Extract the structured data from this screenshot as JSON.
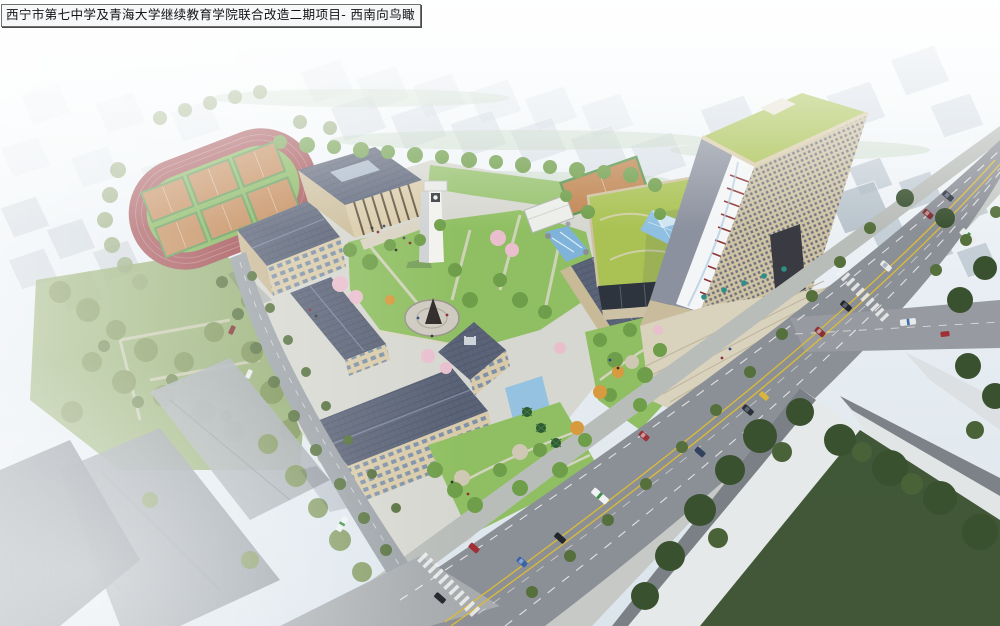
{
  "title": {
    "text": "西宁市第七中学及青海大学继续教育学院联合改造二期项目- 西南向鸟瞰"
  },
  "scene": {
    "type": "aerial-architectural-rendering",
    "landmarks": [
      "running-track",
      "basketball-courts",
      "school-campus-buildings",
      "clock-tower",
      "auditorium",
      "statue-plaza",
      "highrise-tower",
      "podium-green-roof",
      "glass-pyramid-skylight",
      "entrance-plaza",
      "main-avenue",
      "street-intersection",
      "crosswalks",
      "city-context-blocks",
      "park-trees",
      "street-trees",
      "water-cascade"
    ]
  },
  "colors": {
    "sky_top": "#fafdfe",
    "sky_bottom": "#dce5ec",
    "track_red": "#a04a4e",
    "infield_green": "#7fb254",
    "court_orange": "#c08551",
    "court_line_green": "#58944e",
    "roof_slate": "#5a6377",
    "wall_beige": "#d9cba9",
    "window_blue": "#7e91a8",
    "lawn_green": "#8fbf62",
    "tree_green": "#6f9e4a",
    "tree_olive": "#7b9355",
    "tree_dark": "#3a5130",
    "blossom_pink": "#e9bfce",
    "autumn_orange": "#d79a3f",
    "road_grey": "#8b8f96",
    "sidewalk_grey": "#b9bdb9",
    "marking_yellow": "#d8b93c",
    "marking_white": "#f2f2f2",
    "tower_wall": "#cfc3a3",
    "tower_roof_green": "#a9c253",
    "ribbon_white": "#f4f5f6",
    "ribbon_red": "#8d3434",
    "glass_blue": "#8fc0e2",
    "podium_glass": "#2e343d",
    "plaza_beige": "#d9d2bd",
    "umbrella_teal": "#2e8f86",
    "context_grey": "#c4cfd9",
    "massing_white": "#e6e9e9",
    "water_blue": "#7fb3d9",
    "statue_dark": "#2e2a28"
  }
}
